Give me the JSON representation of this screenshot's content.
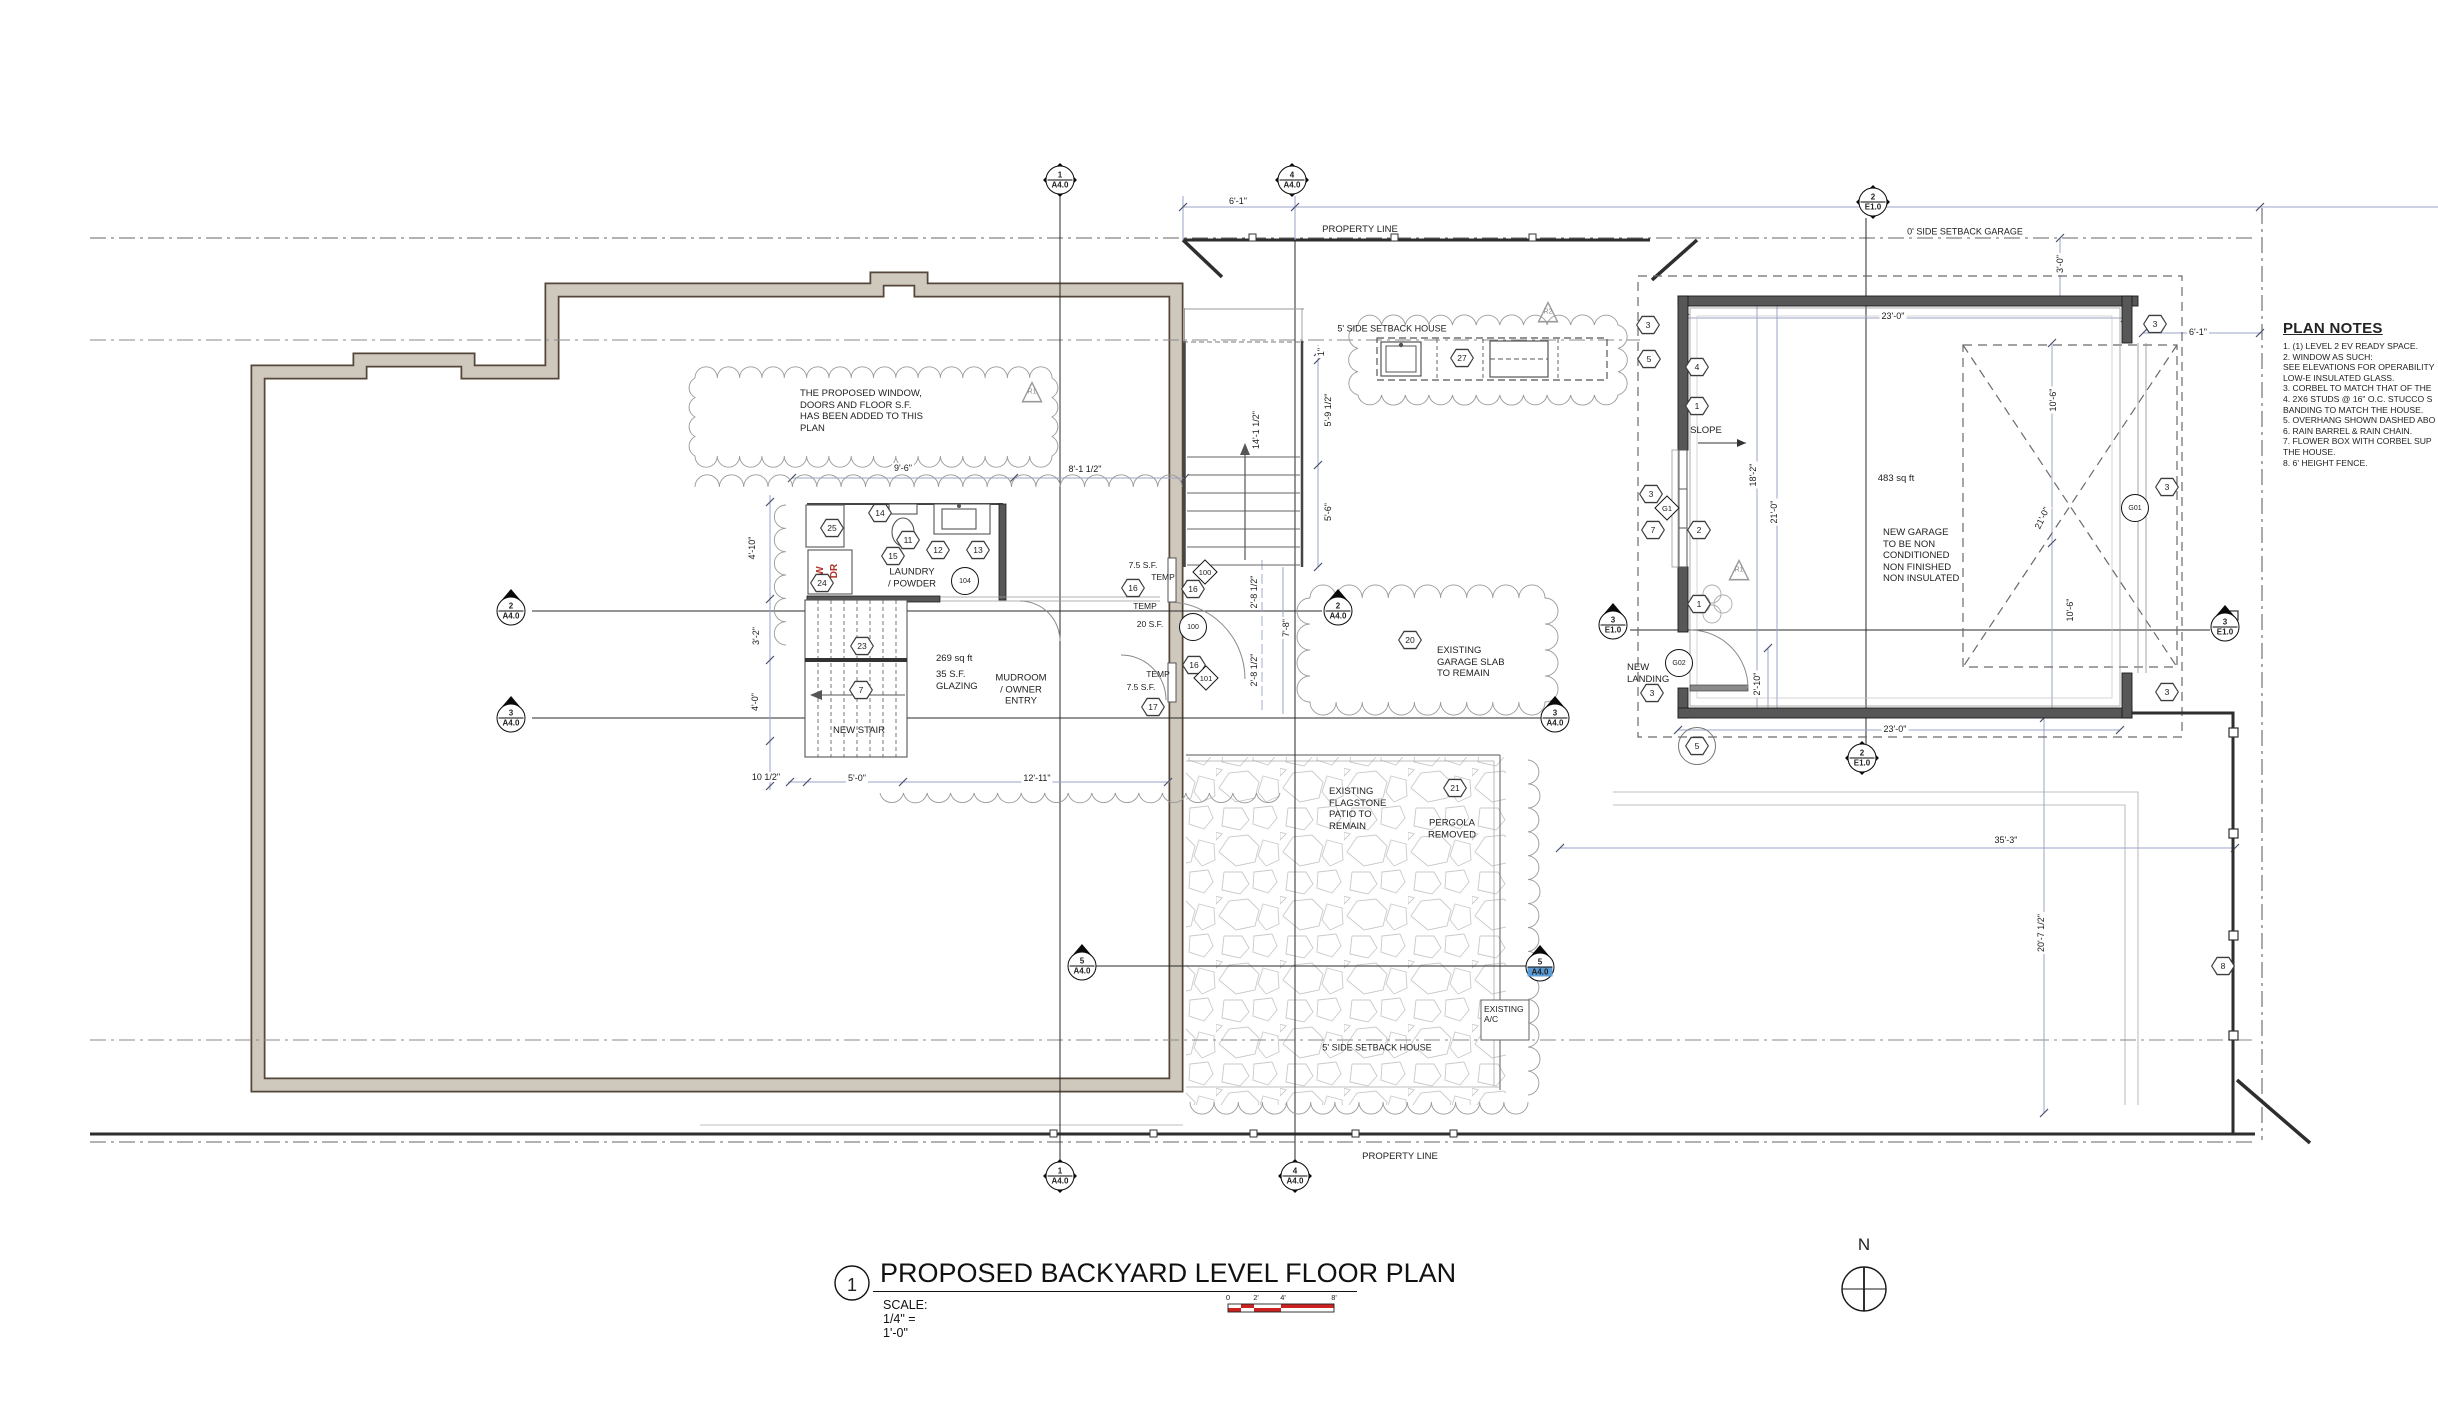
{
  "drawing": {
    "title_number": "1",
    "title": "PROPOSED BACKYARD LEVEL FLOOR PLAN",
    "scale_label": "SCALE: 1/4\"   =    1'-0\"",
    "scale_bar_ticks": [
      "0",
      "2'",
      "4'",
      "8'"
    ],
    "north_label": "N"
  },
  "plan_notes": {
    "heading": "PLAN NOTES",
    "lines": [
      "1. (1) LEVEL 2 EV READY SPACE.",
      "2. WINDOW AS SUCH:",
      "SEE ELEVATIONS FOR OPERABILITY",
      "LOW-E INSULATED GLASS.",
      "3. CORBEL TO MATCH THAT OF THE",
      "4. 2X6 STUDS @ 16\" O.C. STUCCO S",
      "BANDING TO MATCH THE HOUSE.",
      "5. OVERHANG SHOWN DASHED ABO",
      "6. RAIN BARREL & RAIN CHAIN.",
      "7. FLOWER BOX WITH CORBEL SUP",
      "THE HOUSE.",
      "8. 6' HEIGHT FENCE."
    ]
  },
  "labels": [
    {
      "id": "property-line-top",
      "text": "PROPERTY LINE",
      "x": 1360,
      "y": 230,
      "a": "c",
      "s": 9.5
    },
    {
      "id": "property-line-bottom",
      "text": "PROPERTY LINE",
      "x": 1400,
      "y": 1157,
      "a": "c",
      "s": 9.5
    },
    {
      "id": "setback-house-top",
      "text": "5' SIDE SETBACK HOUSE",
      "x": 1392,
      "y": 329,
      "a": "c",
      "s": 9
    },
    {
      "id": "setback-garage",
      "text": "0' SIDE SETBACK GARAGE",
      "x": 1965,
      "y": 232,
      "a": "c",
      "s": 9
    },
    {
      "id": "setback-house-bottom",
      "text": "5' SIDE SETBACK HOUSE",
      "x": 1377,
      "y": 1048,
      "a": "c",
      "s": 9
    },
    {
      "id": "revision-note",
      "text": "THE PROPOSED WINDOW,\nDOORS AND FLOOR S.F.\nHAS BEEN ADDED TO THIS\nPLAN",
      "x": 800,
      "y": 388,
      "a": "l",
      "s": 9.5
    },
    {
      "id": "laundry-room",
      "text": "LAUNDRY\n/ POWDER",
      "x": 912,
      "y": 578,
      "a": "c",
      "s": 9.5
    },
    {
      "id": "mudroom-sqft",
      "text": "269 sq ft",
      "x": 936,
      "y": 653,
      "a": "l",
      "s": 9.5
    },
    {
      "id": "mudroom-glazing",
      "text": "35 S.F.\nGLAZING",
      "x": 936,
      "y": 669,
      "a": "l",
      "s": 9.5
    },
    {
      "id": "mudroom-room",
      "text": "MUDROOM\n/ OWNER\nENTRY",
      "x": 1021,
      "y": 690,
      "a": "c",
      "s": 9.5
    },
    {
      "id": "new-stair",
      "text": "NEW STAIR",
      "x": 859,
      "y": 731,
      "a": "c",
      "s": 9.5
    },
    {
      "id": "win100-sf",
      "text": "7.5 S.F.",
      "x": 1143,
      "y": 565,
      "a": "c",
      "s": 8.5
    },
    {
      "id": "win100-temp",
      "text": "TEMP",
      "x": 1163,
      "y": 577,
      "a": "c",
      "s": 8.5
    },
    {
      "id": "door100-temp",
      "text": "TEMP",
      "x": 1145,
      "y": 606,
      "a": "c",
      "s": 8.5
    },
    {
      "id": "door100-sf",
      "text": "20 S.F.",
      "x": 1150,
      "y": 624,
      "a": "c",
      "s": 8.5
    },
    {
      "id": "win101-temp",
      "text": "TEMP",
      "x": 1158,
      "y": 674,
      "a": "c",
      "s": 8.5
    },
    {
      "id": "win101-sf",
      "text": "7.5 S.F.",
      "x": 1141,
      "y": 687,
      "a": "c",
      "s": 8.5
    },
    {
      "id": "washer",
      "text": "W",
      "x": 821,
      "y": 571,
      "a": "c",
      "s": 10,
      "r": -90,
      "col": "#b03228",
      "b": 1
    },
    {
      "id": "dryer",
      "text": "DR",
      "x": 835,
      "y": 571,
      "a": "c",
      "s": 10,
      "r": -90,
      "col": "#b03228",
      "b": 1
    },
    {
      "id": "slope",
      "text": "SLOPE",
      "x": 1706,
      "y": 431,
      "a": "c",
      "s": 9.5
    },
    {
      "id": "garage-sqft",
      "text": "483 sq ft",
      "x": 1896,
      "y": 479,
      "a": "c",
      "s": 9.5
    },
    {
      "id": "garage-note",
      "text": "NEW GARAGE\nTO BE NON\nCONDITIONED\nNON FINISHED\nNON INSULATED",
      "x": 1883,
      "y": 527,
      "a": "l",
      "s": 9.5
    },
    {
      "id": "slab-note",
      "text": "EXISTING\nGARAGE SLAB\nTO REMAIN",
      "x": 1437,
      "y": 645,
      "a": "l",
      "s": 9.5
    },
    {
      "id": "patio-note",
      "text": "EXISTING\nFLAGSTONE\nPATIO TO\nREMAIN",
      "x": 1329,
      "y": 786,
      "a": "l",
      "s": 9.5
    },
    {
      "id": "pergola-note",
      "text": "PERGOLA\nREMOVED",
      "x": 1452,
      "y": 829,
      "a": "c",
      "s": 9.5
    },
    {
      "id": "ac-unit",
      "text": "EXISTING\nA/C",
      "x": 1484,
      "y": 1004,
      "a": "l",
      "s": 8.5
    },
    {
      "id": "new-landing",
      "text": "NEW\nLANDING",
      "x": 1627,
      "y": 662,
      "a": "l",
      "s": 9.5
    }
  ],
  "dimensions": [
    {
      "t": "6'-1\"",
      "x": 1238,
      "y": 201,
      "r": 0
    },
    {
      "t": "9'-6\"",
      "x": 903,
      "y": 468,
      "r": 0
    },
    {
      "t": "8'-1 1/2\"",
      "x": 1085,
      "y": 469,
      "r": 0
    },
    {
      "t": "4'-10\"",
      "x": 752,
      "y": 548,
      "r": -90
    },
    {
      "t": "3'-2\"",
      "x": 756,
      "y": 636,
      "r": -90
    },
    {
      "t": "4'-0\"",
      "x": 755,
      "y": 702,
      "r": -90
    },
    {
      "t": "10 1/2\"",
      "x": 766,
      "y": 777,
      "r": 0
    },
    {
      "t": "5'-0\"",
      "x": 857,
      "y": 778,
      "r": 0
    },
    {
      "t": "12'-11\"",
      "x": 1037,
      "y": 778,
      "r": 0
    },
    {
      "t": "14'-1 1/2\"",
      "x": 1256,
      "y": 430,
      "r": -90
    },
    {
      "t": "1\"",
      "x": 1321,
      "y": 352,
      "r": -90
    },
    {
      "t": "5'-9 1/2\"",
      "x": 1328,
      "y": 410,
      "r": -90
    },
    {
      "t": "5'-6\"",
      "x": 1328,
      "y": 512,
      "r": -90
    },
    {
      "t": "2'-8 1/2\"",
      "x": 1254,
      "y": 592,
      "r": -90
    },
    {
      "t": "2'-8 1/2\"",
      "x": 1254,
      "y": 670,
      "r": -90
    },
    {
      "t": "7'-8\"",
      "x": 1286,
      "y": 628,
      "r": -90
    },
    {
      "t": "23'-0\"",
      "x": 1893,
      "y": 316,
      "r": 0
    },
    {
      "t": "23'-0\"",
      "x": 1895,
      "y": 729,
      "r": 0
    },
    {
      "t": "18'-2\"",
      "x": 1753,
      "y": 475,
      "r": -90
    },
    {
      "t": "21'-0\"",
      "x": 1774,
      "y": 512,
      "r": -90
    },
    {
      "t": "3'-0\"",
      "x": 2060,
      "y": 264,
      "r": -90
    },
    {
      "t": "10'-6\"",
      "x": 2053,
      "y": 400,
      "r": -90
    },
    {
      "t": "21'-0\"",
      "x": 2042,
      "y": 518,
      "r": -65
    },
    {
      "t": "10'-6\"",
      "x": 2070,
      "y": 610,
      "r": -90
    },
    {
      "t": "6'-1\"",
      "x": 2198,
      "y": 332,
      "r": 0
    },
    {
      "t": "2'-10\"",
      "x": 1757,
      "y": 684,
      "r": -90
    },
    {
      "t": "35'-3\"",
      "x": 2006,
      "y": 840,
      "r": 0
    },
    {
      "t": "20'-7 1/2\"",
      "x": 2041,
      "y": 933,
      "r": -90
    }
  ],
  "keynote_hexagons": [
    {
      "n": "25",
      "x": 832,
      "y": 528
    },
    {
      "n": "14",
      "x": 880,
      "y": 513
    },
    {
      "n": "11",
      "x": 908,
      "y": 540
    },
    {
      "n": "15",
      "x": 893,
      "y": 556
    },
    {
      "n": "12",
      "x": 938,
      "y": 550
    },
    {
      "n": "13",
      "x": 978,
      "y": 550
    },
    {
      "n": "24",
      "x": 822,
      "y": 583
    },
    {
      "n": "23",
      "x": 862,
      "y": 646
    },
    {
      "n": "7",
      "x": 861,
      "y": 690
    },
    {
      "n": "16",
      "x": 1133,
      "y": 588
    },
    {
      "n": "16",
      "x": 1193,
      "y": 589
    },
    {
      "n": "16",
      "x": 1194,
      "y": 665
    },
    {
      "n": "17",
      "x": 1153,
      "y": 707
    },
    {
      "n": "20",
      "x": 1410,
      "y": 640
    },
    {
      "n": "21",
      "x": 1455,
      "y": 788
    },
    {
      "n": "27",
      "x": 1462,
      "y": 358
    },
    {
      "n": "3",
      "x": 1648,
      "y": 325
    },
    {
      "n": "5",
      "x": 1649,
      "y": 359
    },
    {
      "n": "4",
      "x": 1697,
      "y": 367
    },
    {
      "n": "1",
      "x": 1697,
      "y": 406
    },
    {
      "n": "3",
      "x": 1651,
      "y": 494
    },
    {
      "n": "7",
      "x": 1653,
      "y": 530
    },
    {
      "n": "2",
      "x": 1699,
      "y": 530
    },
    {
      "n": "1",
      "x": 1699,
      "y": 604
    },
    {
      "n": "3",
      "x": 1652,
      "y": 693
    },
    {
      "n": "3",
      "x": 2155,
      "y": 324
    },
    {
      "n": "3",
      "x": 2167,
      "y": 487
    },
    {
      "n": "3",
      "x": 2167,
      "y": 692
    },
    {
      "n": "8",
      "x": 2223,
      "y": 966
    },
    {
      "n": "5",
      "x": 1697,
      "y": 746,
      "circled": true
    }
  ],
  "tag_circles": [
    {
      "n": "104",
      "x": 965,
      "y": 581
    },
    {
      "n": "100",
      "x": 1193,
      "y": 627
    },
    {
      "n": "G01",
      "x": 2135,
      "y": 508
    },
    {
      "n": "G02",
      "x": 1679,
      "y": 663
    }
  ],
  "tag_diamonds": [
    {
      "n": "100",
      "x": 1205,
      "y": 572
    },
    {
      "n": "101",
      "x": 1206,
      "y": 678
    },
    {
      "n": "G1",
      "x": 1667,
      "y": 508
    }
  ],
  "revision_triangles": [
    {
      "n": "R1",
      "x": 1032,
      "y": 390
    },
    {
      "n": "R2",
      "x": 1548,
      "y": 310
    },
    {
      "n": "R1",
      "x": 1739,
      "y": 568
    }
  ],
  "section_markers": [
    {
      "num": "1",
      "sheet": "A4.0",
      "x": 1060,
      "y": 180,
      "style": "d"
    },
    {
      "num": "4",
      "sheet": "A4.0",
      "x": 1292,
      "y": 180,
      "style": "d"
    },
    {
      "num": "2",
      "sheet": "E1.0",
      "x": 1873,
      "y": 202,
      "style": "d"
    },
    {
      "num": "1",
      "sheet": "A4.0",
      "x": 1060,
      "y": 1176,
      "style": "d"
    },
    {
      "num": "4",
      "sheet": "A4.0",
      "x": 1295,
      "y": 1176,
      "style": "d"
    },
    {
      "num": "2",
      "sheet": "E1.0",
      "x": 1862,
      "y": 758,
      "style": "d"
    },
    {
      "num": "2",
      "sheet": "A4.0",
      "x": 511,
      "y": 611,
      "style": "t"
    },
    {
      "num": "3",
      "sheet": "A4.0",
      "x": 511,
      "y": 718,
      "style": "t"
    },
    {
      "num": "2",
      "sheet": "A4.0",
      "x": 1338,
      "y": 611,
      "style": "t"
    },
    {
      "num": "3",
      "sheet": "A4.0",
      "x": 1555,
      "y": 718,
      "style": "t"
    },
    {
      "num": "5",
      "sheet": "A4.0",
      "x": 1082,
      "y": 966,
      "style": "t"
    },
    {
      "num": "5",
      "sheet": "A4.0",
      "x": 1540,
      "y": 967,
      "style": "t",
      "highlight": true
    },
    {
      "num": "3",
      "sheet": "E1.0",
      "x": 1613,
      "y": 625,
      "style": "t"
    },
    {
      "num": "3",
      "sheet": "E1.0",
      "x": 2225,
      "y": 627,
      "style": "t"
    }
  ],
  "colors": {
    "wall_new": "#575757",
    "wall_existing_fill": "#cfc8bd",
    "wall_existing_edge": "#54473a",
    "dim_line": "#9aa3c7",
    "accent_red": "#c0392b",
    "highlight_blue": "#5b9bd5",
    "cloud": "#9a9a9a",
    "stone": "#c9c9c9"
  }
}
